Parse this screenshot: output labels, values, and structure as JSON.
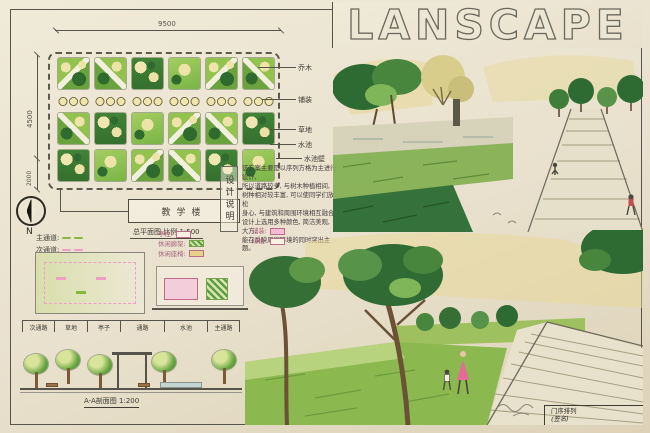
{
  "board": {
    "title": "LANSCAPE",
    "north_label": "N"
  },
  "plan": {
    "dim_top": "9500",
    "dim_left": "4500",
    "dim_left_lower": "2000",
    "callouts": [
      "乔木",
      "铺装",
      "草地",
      "水池",
      "水池壁"
    ],
    "building_label": "教学楼",
    "caption": "总平面图  比例 1:500"
  },
  "design_notes": {
    "label": "设计说明",
    "lines": [
      "该方案主要是以序列方格为主进行设计,",
      "所以道路较多, 与树木种植相间,",
      "树种相对较丰富, 可以使同学们放松",
      "身心, 与建筑和周围环境相互融合,",
      "设计上选用多种颜色, 简洁美观, 大方,",
      "能在反映周围环境的同时突出主题。"
    ]
  },
  "legend": {
    "paths": [
      {
        "label": "主通道:",
        "color": "#86b83e"
      },
      {
        "label": "次通道:",
        "color": "#ef9ec6"
      }
    ],
    "structures": [
      {
        "label": "亭柱:"
      },
      {
        "label": "休闲廊架:"
      },
      {
        "label": "休闲座椅:"
      }
    ],
    "surfaces": [
      {
        "label": "铺装:"
      },
      {
        "label": "绿植:"
      }
    ]
  },
  "section": {
    "segments": [
      "次通路",
      "草地",
      "亭子",
      "通路",
      "水池",
      "主通路"
    ],
    "caption": "A-A剖面图 1:200"
  },
  "titleblock": {
    "line1": "门序排列",
    "line2": "(签名)"
  },
  "colors": {
    "paper": "#ebe4d2",
    "frame": "#56534a",
    "green_dark": "#2e6b33",
    "green_mid": "#6aa742",
    "green_light": "#a9cf6a",
    "yellow_wash": "#e7d795",
    "pink": "#ef9ec6"
  }
}
